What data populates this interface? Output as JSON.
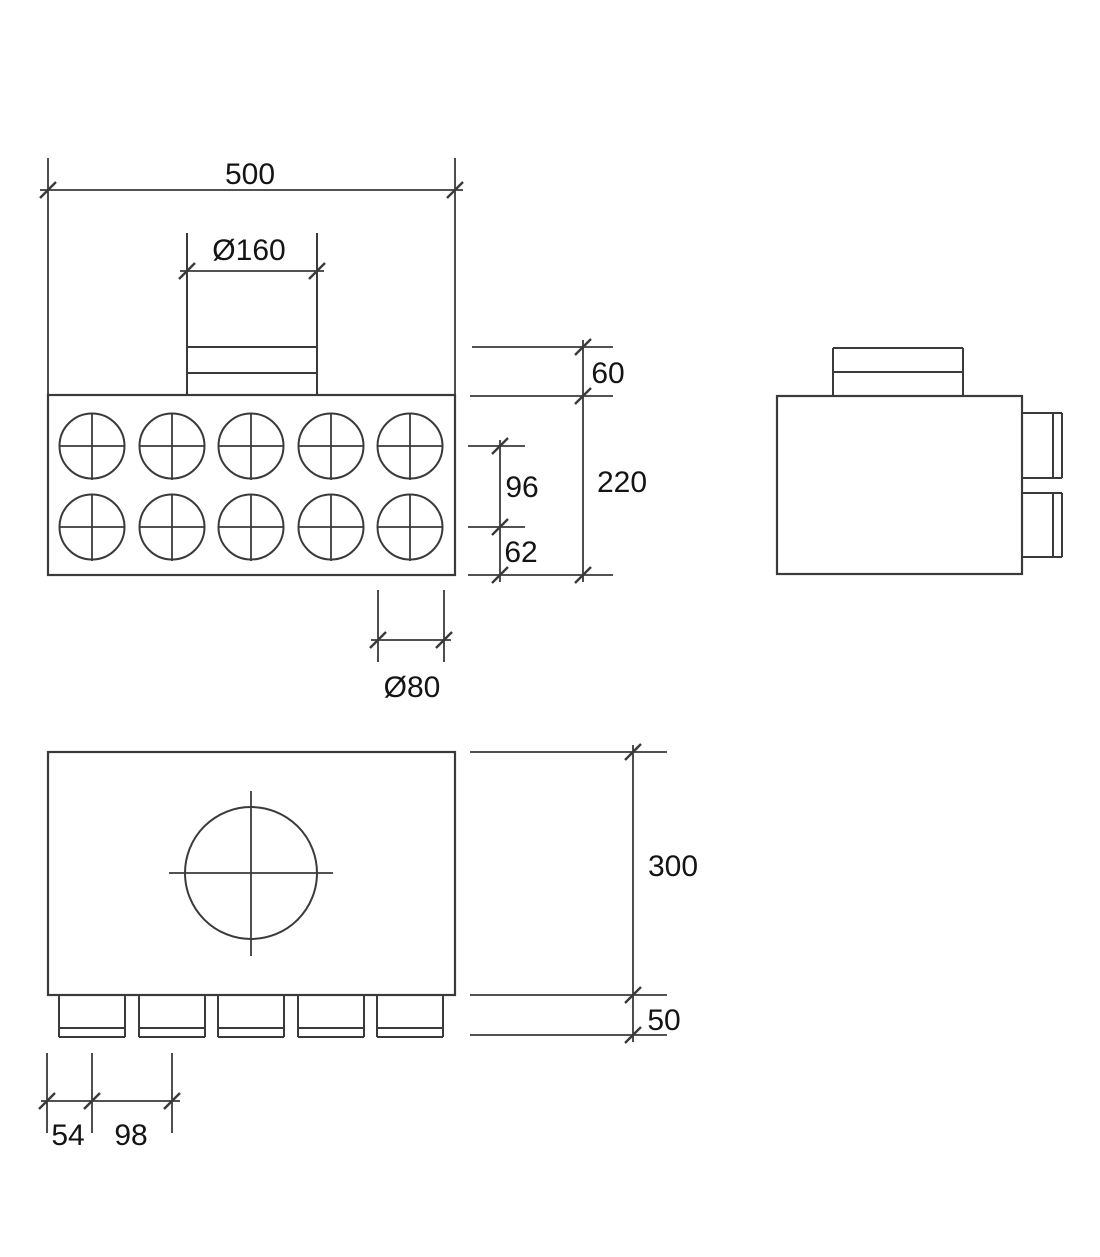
{
  "document": {
    "type": "technical-drawing",
    "subject": "air-distribution-plenum-box"
  },
  "colors": {
    "line": "#3a3a3a",
    "text": "#141414",
    "background": "#ffffff"
  },
  "views": {
    "front": {
      "port_rows": 2,
      "port_columns": 5,
      "port_count": 10
    },
    "side": {
      "side_stub_count": 2
    },
    "bottom": {
      "bottom_stub_count": 5
    }
  },
  "dimensions": {
    "overall_width": "500",
    "top_spigot_diameter": "Ø160",
    "spigot_collar_height": "60",
    "body_height": "220",
    "port_row_spacing": "96",
    "bottom_row_offset": "62",
    "port_diameter": "Ø80",
    "body_depth": "300",
    "stub_length": "50",
    "first_port_offset": "54",
    "port_pitch": "98"
  }
}
